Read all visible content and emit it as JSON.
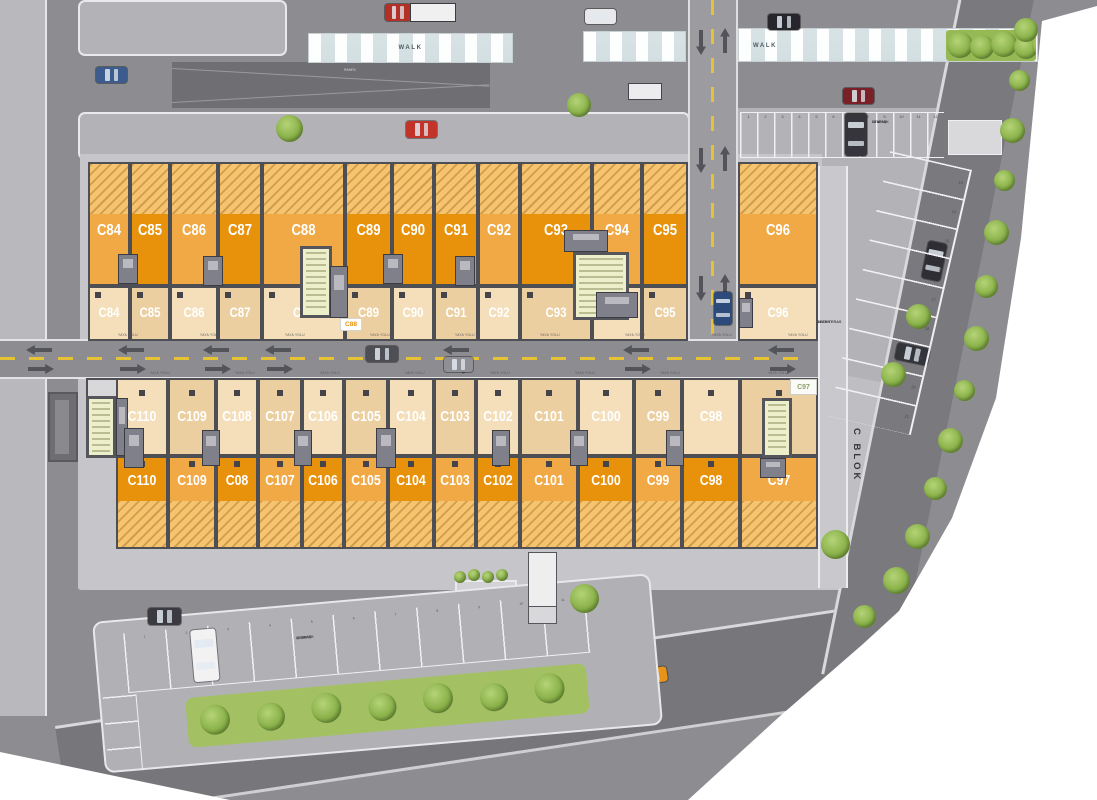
{
  "site": {
    "block_name": "C BLOK",
    "common_area": [
      "ORTAK",
      "ALAN TERAS"
    ],
    "walk_label": "WALK",
    "pedestrian_path": "YAYA YOLU"
  },
  "notes": {
    "ramp": [
      "RAMPA",
      "·······",
      "·······"
    ],
    "road": [
      "·······",
      "·······"
    ],
    "north_core_tag": "C88",
    "south_corner_tag": "C97"
  },
  "north_building": {
    "units": [
      "C84",
      "C85",
      "C86",
      "C87",
      "C88",
      "C89",
      "C90",
      "C91",
      "C92",
      "C93",
      "C94",
      "C95",
      "C96"
    ]
  },
  "south_building": {
    "upper_units": [
      "C110",
      "C109",
      "C108",
      "C107",
      "C106",
      "C105",
      "C104",
      "C103",
      "C102",
      "C101",
      "C100",
      "C99",
      "C98",
      "C97"
    ],
    "lower_units": [
      "C110",
      "C109",
      "C08",
      "C107",
      "C106",
      "C105",
      "C104",
      "C103",
      "C102",
      "C101",
      "C100",
      "C99",
      "C98",
      "C97"
    ]
  },
  "parking": {
    "north_label": [
      "OTOPARK",
      "12 ARAÇ"
    ],
    "north_stalls": [
      "1",
      "2",
      "3",
      "4",
      "5",
      "6",
      "7",
      "8",
      "9",
      "10",
      "11",
      "12"
    ],
    "east_stalls": [
      "13",
      "14",
      "15",
      "16",
      "17",
      "18",
      "19",
      "20",
      "21"
    ],
    "south_label": [
      "OTOPARK",
      "11 ARAÇ"
    ],
    "south_stalls": [
      "1",
      "2",
      "3",
      "4",
      "5",
      "6",
      "7",
      "8",
      "9",
      "10",
      "11"
    ]
  },
  "colors": {
    "unit_dark": "#e8920c",
    "unit_medium": "#f0a945",
    "unit_hatch": "#f6c36e",
    "cream_a": "#f4dfba",
    "cream_b": "#eccfa0",
    "stair_core": "#edefcb",
    "road_dash": "#e6c235",
    "tree": "#85b346",
    "taxi": "#e8941a"
  }
}
